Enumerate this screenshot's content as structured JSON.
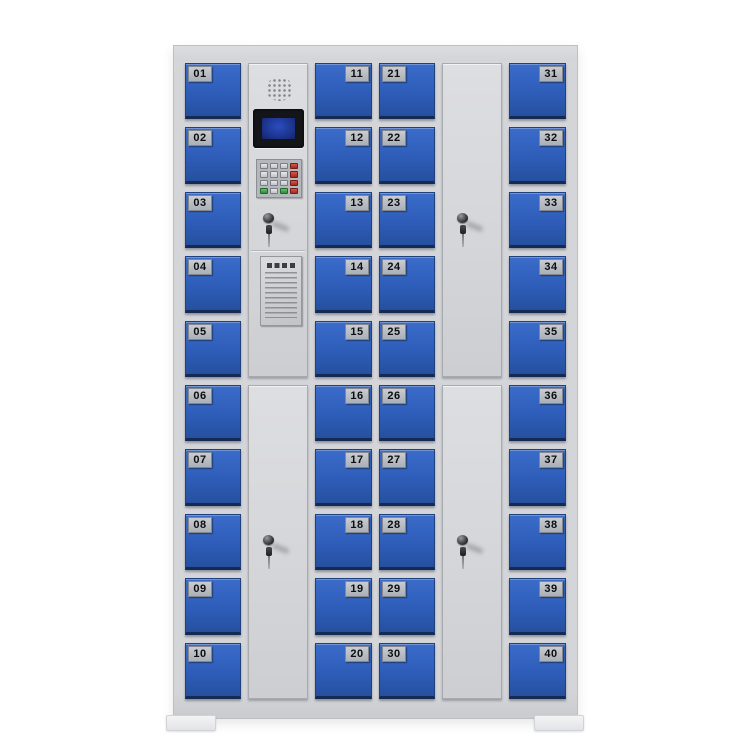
{
  "background_color": "#ffffff",
  "cabinet": {
    "frame_color": "#d4d6d9",
    "door_color": "#2f5db8",
    "panel_color": "#d6d8db",
    "plate_color": "#b6bac0",
    "plate_text_color": "#0d0e10",
    "lcd_bezel_color": "#141518",
    "lcd_screen_color": "#1d3a9e",
    "key_colors": {
      "gray": "#ced1d5",
      "red": "#b5372b",
      "green": "#3f9d47"
    },
    "lockers": {
      "col1": {
        "plate_side": "left",
        "numbers": [
          "01",
          "02",
          "03",
          "04",
          "05",
          "06",
          "07",
          "08",
          "09",
          "10"
        ]
      },
      "col3": {
        "plate_side": "right",
        "numbers": [
          "11",
          "12",
          "13",
          "14",
          "15",
          "16",
          "17",
          "18",
          "19",
          "20"
        ]
      },
      "col4": {
        "plate_side": "left",
        "numbers": [
          "21",
          "22",
          "23",
          "24",
          "25",
          "26",
          "27",
          "28",
          "29",
          "30"
        ]
      },
      "col6": {
        "plate_side": "right",
        "numbers": [
          "31",
          "32",
          "33",
          "34",
          "35",
          "36",
          "37",
          "38",
          "39",
          "40"
        ]
      }
    },
    "control_panel": {
      "components": [
        "speaker-grille",
        "lcd-display",
        "keypad",
        "key-lock",
        "instruction-plate"
      ],
      "keypad_rows": [
        [
          "gray",
          "gray",
          "gray",
          "red"
        ],
        [
          "gray",
          "gray",
          "gray",
          "red"
        ],
        [
          "gray",
          "gray",
          "gray",
          "red"
        ],
        [
          "green",
          "gray",
          "green",
          "red"
        ]
      ]
    },
    "service_doors": [
      "control-column-bottom",
      "fifth-column-top",
      "fifth-column-bottom"
    ],
    "locks_with_keys": 4
  }
}
